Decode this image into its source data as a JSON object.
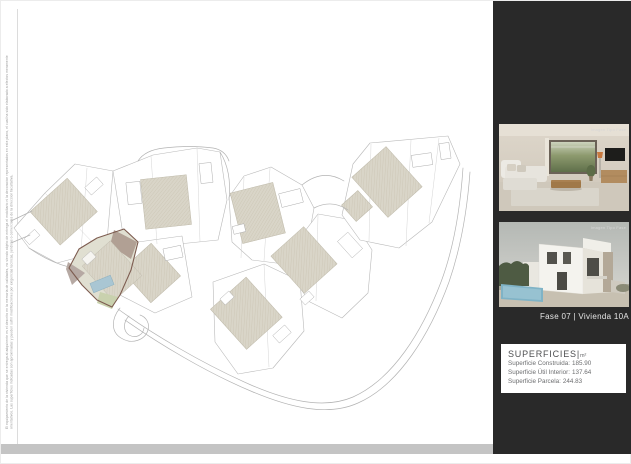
{
  "page": {
    "disclaimer": "El equipamiento de la vivienda que se entrega al adquirente es el descrito en la memoria de calidades, no siendo objeto de entrega el mobiliario ni la decoracion representados en este plano, el cual ha sido elaborado a efectos meramente orientativos. Las superficies indicadas son aproximadas y pueden sufrir modificaciones por exigencias tecnicas, juridicas o comerciales de la direccion facultativa."
  },
  "plan": {
    "highlighted_unit": "Vivienda 10A"
  },
  "sidebar": {
    "interior_caption": "Imagen Tipo Fase",
    "exterior_caption": "Imagen Tipo Fase",
    "unit_label": "Fase 07 |  Vivienda 10A",
    "superficies": {
      "title": "SUPERFICIES",
      "separator": "|",
      "unit": "m²",
      "rows": [
        {
          "label": "Superficie Construida:",
          "value": "185.90"
        },
        {
          "label": "Superficie Útil Interior:",
          "value": "137.64"
        },
        {
          "label": "Superficie Parcela:",
          "value": "244.83"
        }
      ]
    }
  },
  "colors": {
    "sidebar_bg": "#292929",
    "bottom_bar": "#c4c4c4",
    "highlight_outline": "#7d5c50",
    "highlight_fill": "#e0dfd1",
    "pool": "#a9c6d3",
    "roof_hatch": "#d9d5c8"
  }
}
